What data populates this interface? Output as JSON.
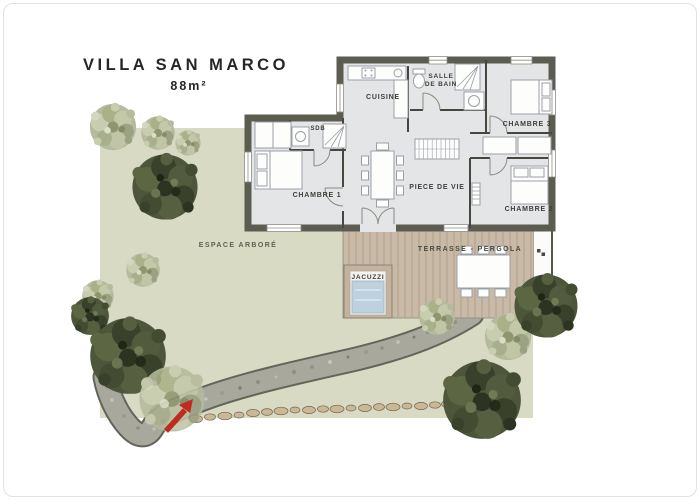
{
  "title": {
    "name": "VILLA SAN MARCO",
    "area": "88m²"
  },
  "rooms": {
    "cuisine": "CUISINE",
    "salle_de_bain_line1": "SALLE",
    "salle_de_bain_line2": "DE BAIN",
    "sdb": "SDB",
    "chambre1": "CHAMBRE 1",
    "chambre2": "CHAMBRE 2",
    "chambre3": "CHAMBRE 3",
    "piece_de_vie": "PIECE DE VIE"
  },
  "exterior": {
    "terrasse": "TERRASSE - PERGOLA",
    "jacuzzi": "JACUZZI",
    "espace_arbore": "ESPACE ARBORÉ"
  },
  "colors": {
    "lawn": "#d9dac3",
    "terrace_wood": "#c9baa7",
    "jacuzzi_water": "#bdd2de",
    "house_floor": "#e4e5e7",
    "wall": "#5c5d50",
    "path_stone": "#a9a89c",
    "stepping_stone": "#c9b795",
    "arrow_red": "#bf2b20",
    "tree_dark": "#4d553a",
    "tree_pale": "#b5bb9d",
    "label_text": "#3f3f3a"
  }
}
